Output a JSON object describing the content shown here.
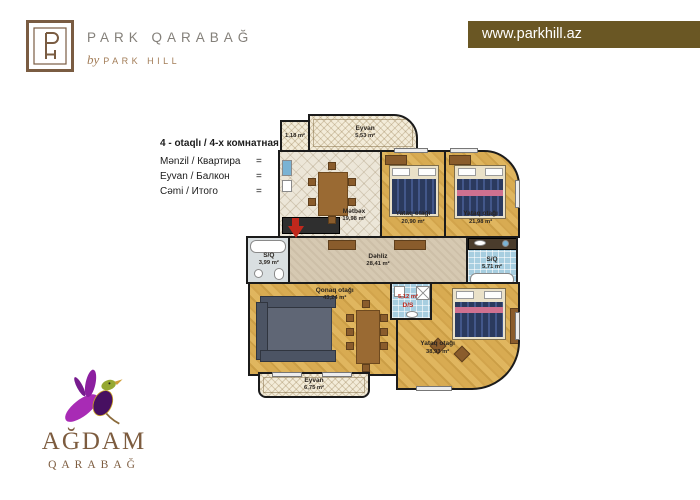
{
  "header": {
    "brand": {
      "name": "PARK QARABAĞ",
      "by_prefix": "by",
      "by_name": "PARK HILL"
    },
    "website": "www.parkhill.az"
  },
  "info": {
    "title": "4 - otaqlı / 4-х комнатная",
    "rows": [
      {
        "label": "Mənzil / Квартира",
        "eq": "=",
        "value": "193,90 m²"
      },
      {
        "label": "Eyvan / Балкон",
        "eq": "=",
        "value": "13,46 m²"
      },
      {
        "label": "Cəmi / Итого",
        "eq": "=",
        "value": "207,36 m²"
      }
    ]
  },
  "floorplan": {
    "rooms": {
      "eyvan_top": {
        "name": "Eyvan",
        "area": "5,53 m²"
      },
      "box_small": {
        "area": "1,18 m²"
      },
      "metbex": {
        "name": "Mətbəx",
        "area": "19,98 m²"
      },
      "yataq1": {
        "name": "Yataq otağı",
        "area": "20,90 m²"
      },
      "yataq2": {
        "name": "Yataq otağı",
        "area": "21,98 m²"
      },
      "dehliz": {
        "name": "Dəhliz",
        "area": "28,41 m²"
      },
      "sq_left": {
        "name": "S/Q",
        "area": "3,99 m²"
      },
      "sq_right": {
        "name": "S/Q",
        "area": "5,71 m²"
      },
      "qonaq": {
        "name": "Qonaq otağı",
        "area": "43,24 m²"
      },
      "ds": {
        "name": "D/S",
        "area": "5,12 m²"
      },
      "yataq3": {
        "name": "Yataq otağı",
        "area": "38,93 m²"
      },
      "eyvan_bottom": {
        "name": "Eyvan",
        "area": "6,75 m²"
      }
    }
  },
  "footer_logo": {
    "title": "AĞDAM",
    "subtitle": "QARABAĞ"
  },
  "colors": {
    "banner": "#6a5724",
    "logo_brown": "#7a5c42",
    "wood": "#d3a54e",
    "accent_red": "#c0281c"
  }
}
